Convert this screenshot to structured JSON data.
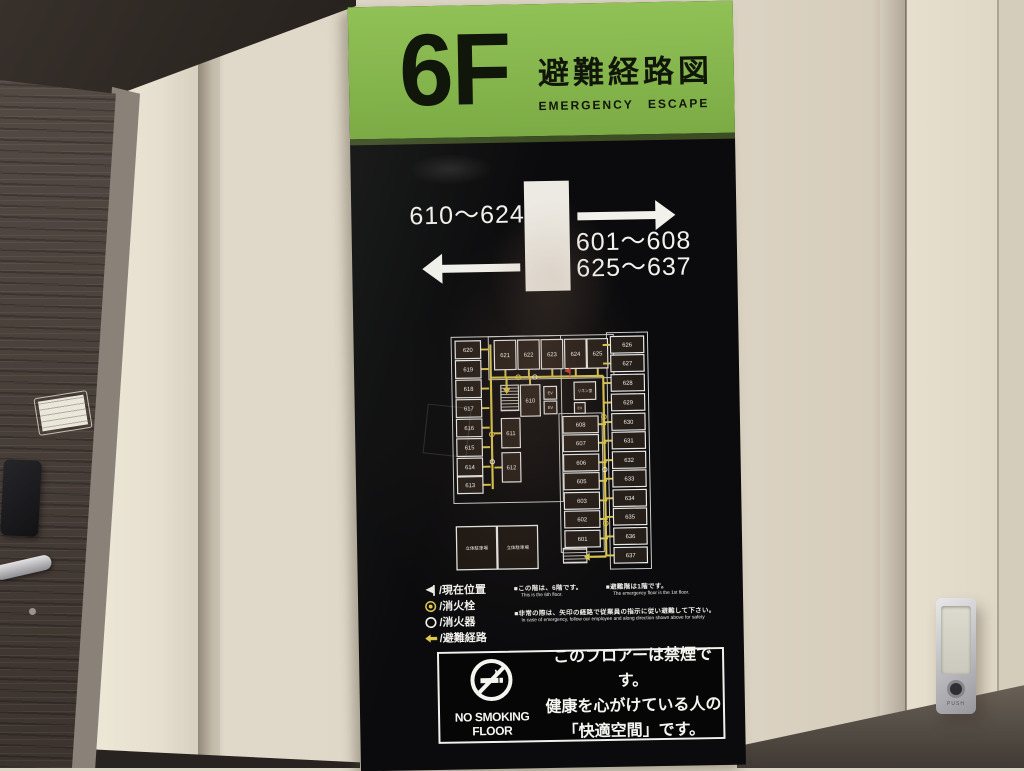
{
  "sign": {
    "header": {
      "floor": "6F",
      "title": "避難経路図",
      "subtitle": "EMERGENCY  ESCAPE",
      "green_color": "#86b94e"
    },
    "directions": {
      "left_rooms": "610〜624",
      "right_rooms_line1": "601〜608",
      "right_rooms_line2": "625〜637"
    },
    "floorplan": {
      "route_color": "#dcc84e",
      "marker_color": "#cd3a2a",
      "parking_label": "立体駐車場",
      "outlines": [
        [
          22,
          12,
          112,
          170
        ],
        [
          60,
          12,
          128,
          44
        ],
        [
          181,
          10,
          42,
          242
        ],
        [
          131,
          92,
          44,
          142
        ]
      ],
      "stairs": [
        [
          72,
          62,
          18,
          26
        ],
        [
          133,
          230,
          24,
          15
        ]
      ],
      "rooms": [
        {
          "label": "620",
          "x": 26,
          "y": 16,
          "w": 26,
          "h": 18,
          "tick": "right"
        },
        {
          "label": "619",
          "x": 26,
          "y": 36,
          "w": 26,
          "h": 18,
          "tick": "right"
        },
        {
          "label": "618",
          "x": 26,
          "y": 56,
          "w": 26,
          "h": 18,
          "tick": "right"
        },
        {
          "label": "617",
          "x": 26,
          "y": 76,
          "w": 26,
          "h": 18,
          "tick": "right"
        },
        {
          "label": "616",
          "x": 26,
          "y": 96,
          "w": 26,
          "h": 18,
          "tick": "right"
        },
        {
          "label": "615",
          "x": 26,
          "y": 116,
          "w": 26,
          "h": 18,
          "tick": "right"
        },
        {
          "label": "614",
          "x": 26,
          "y": 136,
          "w": 26,
          "h": 18,
          "tick": "right"
        },
        {
          "label": "613",
          "x": 26,
          "y": 155,
          "w": 26,
          "h": 17,
          "tick": "right"
        },
        {
          "label": "621",
          "x": 66,
          "y": 16,
          "w": 22,
          "h": 30,
          "tick": "down"
        },
        {
          "label": "622",
          "x": 90,
          "y": 16,
          "w": 22,
          "h": 30,
          "tick": "down"
        },
        {
          "label": "623",
          "x": 114,
          "y": 16,
          "w": 22,
          "h": 30,
          "tick": "down"
        },
        {
          "label": "624",
          "x": 138,
          "y": 16,
          "w": 22,
          "h": 30,
          "tick": "down"
        },
        {
          "label": "625",
          "x": 161,
          "y": 16,
          "w": 21,
          "h": 30,
          "tick": "down"
        },
        {
          "label": "626",
          "x": 185,
          "y": 14,
          "w": 34,
          "h": 17,
          "tick": "left"
        },
        {
          "label": "627",
          "x": 185,
          "y": 33,
          "w": 34,
          "h": 17,
          "tick": "left"
        },
        {
          "label": "628",
          "x": 185,
          "y": 53,
          "w": 34,
          "h": 17,
          "tick": "left"
        },
        {
          "label": "629",
          "x": 185,
          "y": 73,
          "w": 34,
          "h": 17,
          "tick": "left"
        },
        {
          "label": "630",
          "x": 185,
          "y": 93,
          "w": 34,
          "h": 17,
          "tick": "left"
        },
        {
          "label": "631",
          "x": 185,
          "y": 112,
          "w": 34,
          "h": 17,
          "tick": "left"
        },
        {
          "label": "632",
          "x": 185,
          "y": 132,
          "w": 34,
          "h": 17,
          "tick": "left"
        },
        {
          "label": "633",
          "x": 185,
          "y": 151,
          "w": 34,
          "h": 17,
          "tick": "left"
        },
        {
          "label": "634",
          "x": 185,
          "y": 171,
          "w": 34,
          "h": 17,
          "tick": "left"
        },
        {
          "label": "635",
          "x": 185,
          "y": 190,
          "w": 34,
          "h": 17,
          "tick": "left"
        },
        {
          "label": "636",
          "x": 185,
          "y": 210,
          "w": 34,
          "h": 17,
          "tick": "left"
        },
        {
          "label": "637",
          "x": 185,
          "y": 230,
          "w": 34,
          "h": 16,
          "tick": "left"
        },
        {
          "label": "608",
          "x": 135,
          "y": 95,
          "w": 36,
          "h": 17,
          "tick": "right"
        },
        {
          "label": "607",
          "x": 135,
          "y": 114,
          "w": 36,
          "h": 17,
          "tick": "right"
        },
        {
          "label": "606",
          "x": 135,
          "y": 134,
          "w": 36,
          "h": 17,
          "tick": "right"
        },
        {
          "label": "605",
          "x": 135,
          "y": 153,
          "w": 36,
          "h": 17,
          "tick": "right"
        },
        {
          "label": "603",
          "x": 135,
          "y": 173,
          "w": 36,
          "h": 17,
          "tick": "right"
        },
        {
          "label": "602",
          "x": 135,
          "y": 192,
          "w": 36,
          "h": 17,
          "tick": "right"
        },
        {
          "label": "601",
          "x": 135,
          "y": 212,
          "w": 36,
          "h": 17,
          "tick": "right"
        },
        {
          "label": "610",
          "x": 92,
          "y": 62,
          "w": 20,
          "h": 32,
          "tick": "up"
        },
        {
          "label": "611",
          "x": 72,
          "y": 96,
          "w": 19,
          "h": 30,
          "tick": "left"
        },
        {
          "label": "612",
          "x": 72,
          "y": 131,
          "w": 19,
          "h": 30,
          "tick": "left"
        },
        {
          "label": "リネン室",
          "x": 147,
          "y": 60,
          "w": 22,
          "h": 18,
          "fs": 3.8
        },
        {
          "label": "EV",
          "x": 116,
          "y": 64,
          "w": 13,
          "h": 13,
          "fs": 4
        },
        {
          "label": "EV",
          "x": 116,
          "y": 79,
          "w": 13,
          "h": 13,
          "fs": 4
        },
        {
          "label": "EV",
          "x": 147,
          "y": 81,
          "w": 11,
          "h": 11,
          "fs": 3.6
        }
      ],
      "routes": [
        [
          [
            62,
            20
          ],
          [
            62,
            168
          ]
        ],
        [
          [
            62,
            54
          ],
          [
            177,
            54
          ]
        ],
        [
          [
            177,
            54
          ],
          [
            177,
            239
          ]
        ]
      ],
      "route_arrows": [
        [
          177,
          239,
          160,
          239
        ],
        [
          78,
          55,
          78,
          65
        ]
      ],
      "points": [
        {
          "t": "h",
          "x": 90,
          "y": 54
        },
        {
          "t": "h",
          "x": 177,
          "y": 96
        },
        {
          "t": "h",
          "x": 177,
          "y": 205
        },
        {
          "t": "h",
          "x": 62,
          "y": 112
        },
        {
          "t": "e",
          "x": 107,
          "y": 54
        },
        {
          "t": "e",
          "x": 177,
          "y": 150
        },
        {
          "t": "e",
          "x": 62,
          "y": 140
        }
      ],
      "position_marker": {
        "x": 143,
        "y": 50
      },
      "parking_boxes": [
        [
          24,
          206,
          41,
          44
        ],
        [
          66,
          206,
          41,
          44
        ]
      ]
    },
    "legend": {
      "items": [
        {
          "icon": "current-position-flag-icon",
          "label": "/現在位置"
        },
        {
          "icon": "fire-hydrant-icon",
          "label": "/消火栓"
        },
        {
          "icon": "fire-extinguisher-icon",
          "label": "/消火器"
        },
        {
          "icon": "escape-route-arrow-icon",
          "label": "/避難経路"
        }
      ]
    },
    "notes": [
      {
        "jp": "■この階は、6階です。",
        "en": "This is the 6th floor."
      },
      {
        "jp": "■避難階は1階です。",
        "en": "The emergency floor is the 1st floor."
      },
      {
        "jp": "■非常の際は、矢印の経路で従業員の指示に従い避難して下さい。",
        "en": "In case of emergency, follow our employee and along direction shown above for safety"
      }
    ],
    "no_smoking": {
      "label": "NO SMOKING FLOOR",
      "lines": [
        "このフロアーは禁煙です。",
        "健康を心がけている人の",
        "「快適空間」です。"
      ]
    }
  },
  "environment": {
    "push_plate_label": "PUSH"
  }
}
